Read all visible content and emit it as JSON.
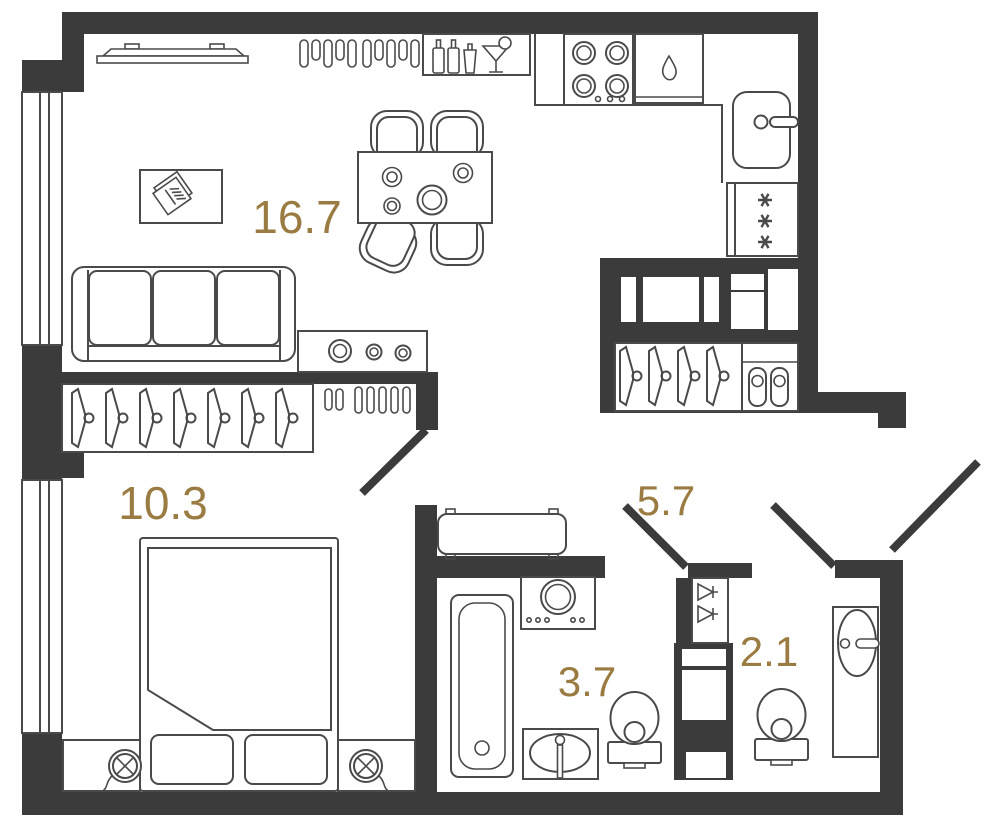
{
  "plan": {
    "rooms": [
      {
        "name": "living-kitchen",
        "area_label": "16.7"
      },
      {
        "name": "bedroom",
        "area_label": "10.3"
      },
      {
        "name": "hallway",
        "area_label": "5.7"
      },
      {
        "name": "bathroom",
        "area_label": "3.7"
      },
      {
        "name": "wc",
        "area_label": "2.1"
      }
    ],
    "colors": {
      "wall": "#3b3b3b",
      "line": "#4a4a4a",
      "accent": "#9a7b42",
      "bg": "#ffffff"
    }
  }
}
